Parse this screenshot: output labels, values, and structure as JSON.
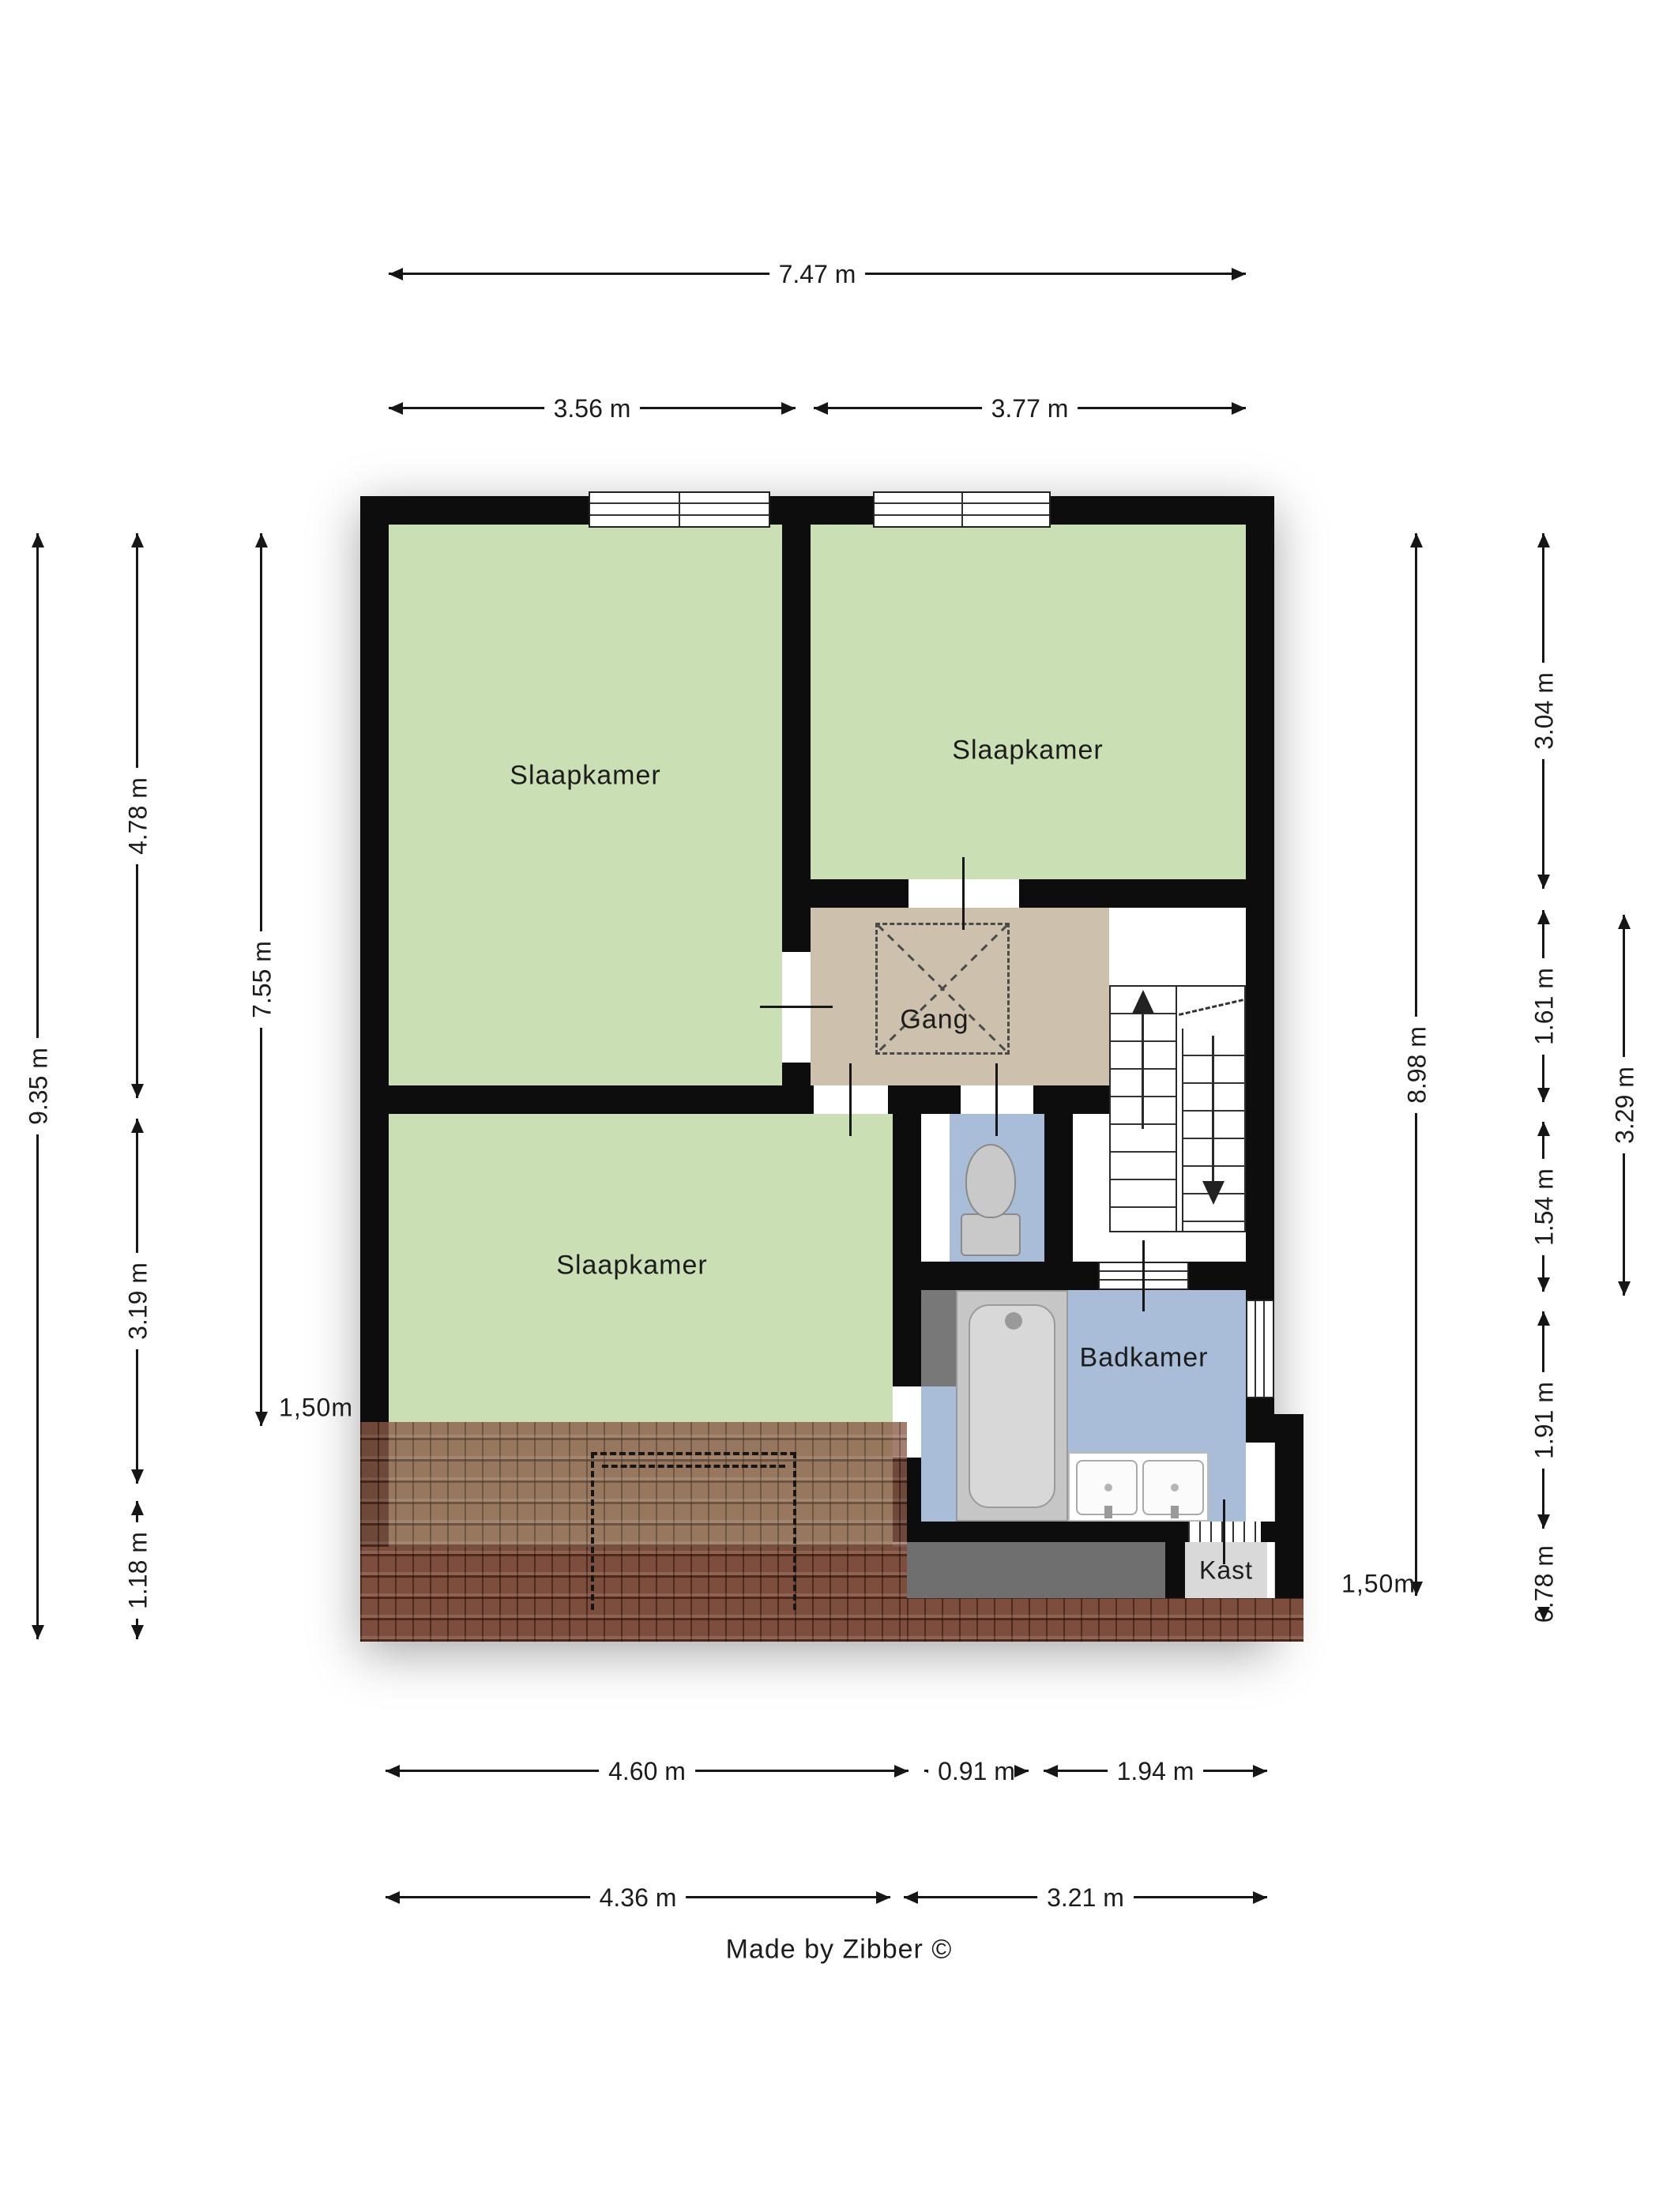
{
  "footer": {
    "credit": "Made by Zibber ©"
  },
  "rooms": {
    "bedroom_top_left": {
      "label": "Slaapkamer",
      "color": "#cbdfb5"
    },
    "bedroom_top_right": {
      "label": "Slaapkamer",
      "color": "#cbdfb5"
    },
    "bedroom_bottom": {
      "label": "Slaapkamer",
      "color": "#cbdfb5"
    },
    "hall": {
      "label": "Gang",
      "color": "#cdc1ae"
    },
    "toilet": {
      "label": "",
      "color": "#a9bdd8"
    },
    "bathroom": {
      "label": "Badkamer",
      "color": "#a9bdd8"
    },
    "closet": {
      "label": "Kast",
      "color": "#d9d9d9"
    }
  },
  "dims": {
    "top": [
      {
        "label": "7.47 m"
      },
      {
        "label": "3.56 m"
      },
      {
        "label": "3.77 m"
      }
    ],
    "bottom": [
      {
        "label": "4.60 m"
      },
      {
        "label": "0.91 m"
      },
      {
        "label": "1.94 m"
      },
      {
        "label": "4.36 m"
      },
      {
        "label": "3.21 m"
      }
    ],
    "left": [
      {
        "label": "9.35 m"
      },
      {
        "label": "4.78 m"
      },
      {
        "label": "3.19 m"
      },
      {
        "label": "1.18 m"
      },
      {
        "label": "7.55 m"
      },
      {
        "label": "1,50m"
      }
    ],
    "right": [
      {
        "label": "8.98 m"
      },
      {
        "label": "3.04 m"
      },
      {
        "label": "1.61 m"
      },
      {
        "label": "1.54 m"
      },
      {
        "label": "1.91 m"
      },
      {
        "label": "0.78 m"
      },
      {
        "label": "3.29 m"
      },
      {
        "label": "1,50m"
      }
    ]
  },
  "colors": {
    "wall": "#0d0d0d",
    "room_green": "#cbdfb5",
    "hall_tan": "#cdc1ae",
    "wet_blue": "#a9bdd8",
    "closet_gray": "#d9d9d9",
    "roof_brown": "#8a5a47",
    "band_gray": "#6f6f6f",
    "fixture_gray": "#c9c9c9"
  }
}
